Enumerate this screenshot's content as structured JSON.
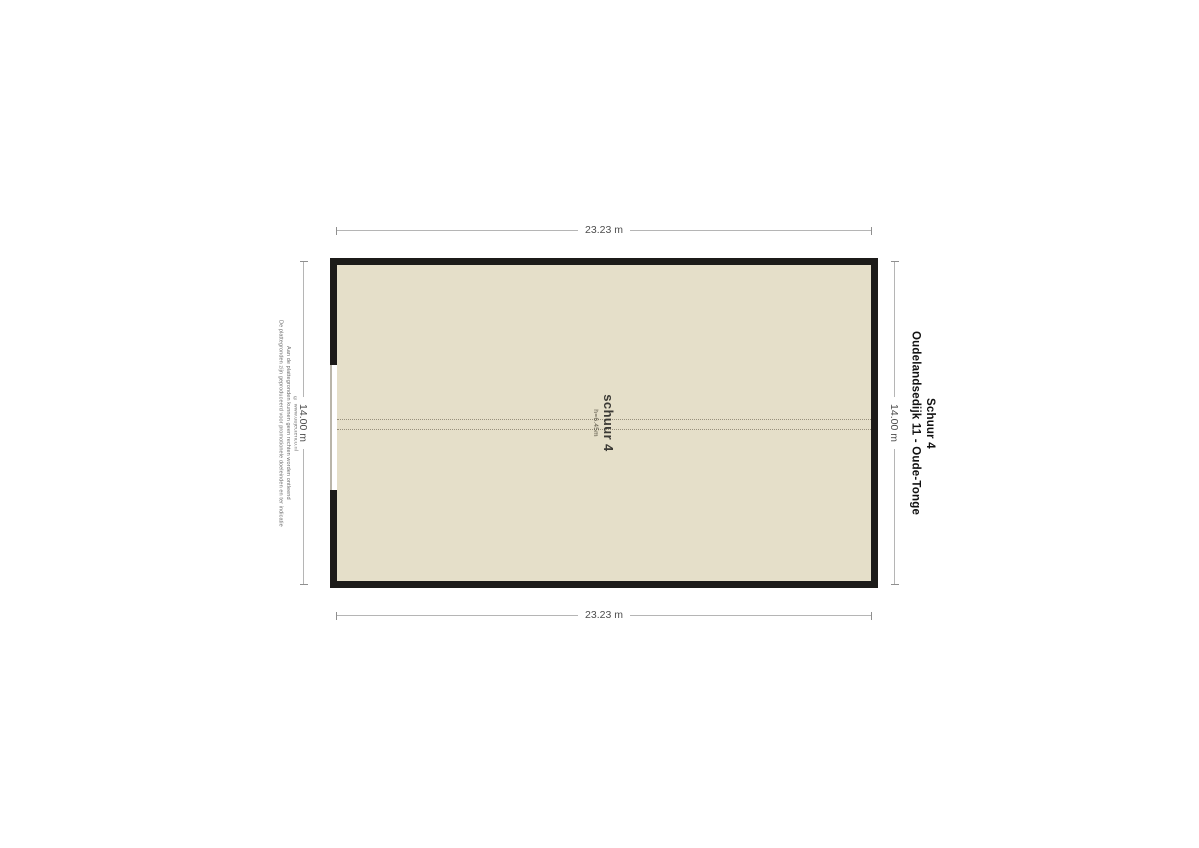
{
  "page": {
    "background_color": "#ffffff"
  },
  "plan": {
    "room": {
      "name": "schuur 4",
      "height_label": "h=6.45m"
    },
    "dimensions": {
      "top": "23.23 m",
      "bottom": "23.23 m",
      "left": "14.00 m",
      "right": "14.00 m"
    },
    "colors": {
      "floor_fill": "#e5dfc9",
      "wall": "#1c1b19",
      "ridge_dash": "#97907c",
      "dimension_line": "#b5b5b5",
      "dimension_text": "#4d4d4d"
    }
  },
  "title": {
    "line1": "Oudelandsedijk 11 - Oude-Tonge",
    "line2": "Schuur 4"
  },
  "disclaimer": {
    "line1": "De plattegronden zijn geproduceerd voor promotionele doeleinden en ter indicatie",
    "line2": "Aan de plattegronden kunnen geen rechten worden ontleend",
    "line3": "© www.objectenco.nl"
  }
}
